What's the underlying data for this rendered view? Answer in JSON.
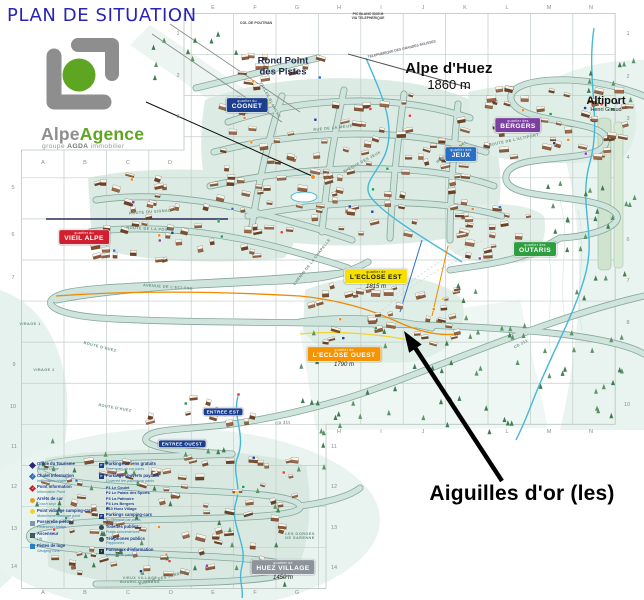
{
  "title": "PLAN DE SITUATION",
  "logo": {
    "brand_gray": "Alpe",
    "brand_green": "Agence",
    "tagline_prefix": "groupe",
    "tagline_bold": "AGDA",
    "tagline_suffix": "immobilier"
  },
  "resort": {
    "name": "Alpe d'Huez",
    "altitude": "1860 m"
  },
  "annotation": {
    "label": "Aiguilles d'or (les)"
  },
  "places": [
    {
      "text": "Rond Point\ndes Pistes",
      "x": 283,
      "y": 67,
      "size": 9.5,
      "weight": "bold",
      "color": "#1d2b50"
    },
    {
      "text": "Altiport",
      "sub": "Henri Giraud",
      "x": 606,
      "y": 104,
      "size": 11,
      "weight": "bold",
      "color": "#111"
    },
    {
      "text": "COL DE POUTRAN",
      "x": 256,
      "y": 23,
      "size": 3.6,
      "weight": "bold",
      "color": "#444"
    },
    {
      "text": "PIC BLANC 3330 M\nVIA TELEPHERIQUE",
      "x": 368,
      "y": 17,
      "size": 3.4,
      "weight": "bold",
      "color": "#444"
    },
    {
      "text": "TELEPHERIQUE DES GRANDES ROUSSES",
      "x": 402,
      "y": 50,
      "size": 3.4,
      "weight": "bold",
      "color": "#667",
      "rot": -13
    }
  ],
  "quartier_badges": [
    {
      "prefix": "quartier du",
      "name": "COGNET",
      "bg": "#1b3f8e",
      "fg": "#ffffff",
      "x": 247,
      "y": 105
    },
    {
      "prefix": "quartier des",
      "name": "JEUX",
      "bg": "#2a6fc4",
      "fg": "#ffffff",
      "x": 461,
      "y": 154
    },
    {
      "prefix": "quartier des",
      "name": "BERGERS",
      "bg": "#7b3fa0",
      "fg": "#ffffff",
      "x": 518,
      "y": 125
    },
    {
      "prefix": "quartier du",
      "name": "VIEIL ALPE",
      "bg": "#d01f2e",
      "fg": "#ffffff",
      "x": 84,
      "y": 237
    },
    {
      "prefix": "quartier des",
      "name": "OUTARIS",
      "bg": "#2f9e41",
      "fg": "#ffffff",
      "x": 535,
      "y": 249
    },
    {
      "prefix": "quartier de",
      "name": "L'ECLOSE EST",
      "bg": "#f6e000",
      "fg": "#111111",
      "x": 376,
      "y": 276,
      "alt": "1815 m"
    },
    {
      "prefix": "quartier de",
      "name": "L'ECLOSE OUEST",
      "bg": "#f59300",
      "fg": "#ffffff",
      "x": 344,
      "y": 354,
      "alt": "1790 m"
    },
    {
      "prefix": "quartier de",
      "name": "HUEZ VILLAGE",
      "bg": "#8d939b",
      "fg": "#ffffff",
      "x": 283,
      "y": 567,
      "alt": "1450 m"
    },
    {
      "prefix": "",
      "name": "ENTREE EST",
      "bg": "#1b3f8e",
      "fg": "#ffffff",
      "x": 223,
      "y": 412,
      "small": true
    },
    {
      "prefix": "",
      "name": "ENTREE OUEST",
      "bg": "#1b3f8e",
      "fg": "#ffffff",
      "x": 182,
      "y": 444,
      "small": true
    }
  ],
  "road_labels": [
    {
      "text": "ROUTE DU SIGNAL",
      "x": 150,
      "y": 212,
      "rot": -4
    },
    {
      "text": "ROUTE DE LA POSTE",
      "x": 150,
      "y": 229,
      "rot": 3
    },
    {
      "text": "ROUTE D'HUEZ",
      "x": 100,
      "y": 347,
      "rot": 14
    },
    {
      "text": "ROUTE D'HUEZ",
      "x": 115,
      "y": 408,
      "rot": 10
    },
    {
      "text": "AVENUE DE L'ECLOSE",
      "x": 168,
      "y": 287,
      "rot": 4
    },
    {
      "text": "CHEMIN DE LA CHAPELLE",
      "x": 312,
      "y": 262,
      "rot": -52
    },
    {
      "text": "ROUTE DE L'ALTIPORT",
      "x": 514,
      "y": 140,
      "rot": -12
    },
    {
      "text": "RUE DE LA MEIJE",
      "x": 333,
      "y": 128,
      "rot": -6
    },
    {
      "text": "AVENUE DES JEUX",
      "x": 362,
      "y": 162,
      "rot": -28
    },
    {
      "text": "RUE DU RIF NEL",
      "x": 452,
      "y": 152,
      "rot": -35
    },
    {
      "text": "VALLEE BLANCHE",
      "x": 270,
      "y": 100,
      "rot": 62
    },
    {
      "text": "CD 211",
      "x": 283,
      "y": 423,
      "rot": -4
    },
    {
      "text": "CD 211",
      "x": 521,
      "y": 344,
      "rot": -28
    },
    {
      "text": "AVENUE DES JARDINS",
      "x": 163,
      "y": 578,
      "rot": -14
    },
    {
      "text": "VIRAGE 1",
      "x": 30,
      "y": 324,
      "rot": 0
    },
    {
      "text": "VIRAGE 2",
      "x": 44,
      "y": 370,
      "rot": 0
    },
    {
      "text": "LES GORGES\nDE SARENNE",
      "x": 300,
      "y": 536,
      "rot": 0
    },
    {
      "text": "VIEUX VILLAGE\nBOURG-D'OISANS",
      "x": 140,
      "y": 580,
      "rot": 0
    }
  ],
  "grid": {
    "letters": [
      {
        "t": "E",
        "x": 213,
        "y": 8
      },
      {
        "t": "F",
        "x": 255,
        "y": 8
      },
      {
        "t": "G",
        "x": 297,
        "y": 8
      },
      {
        "t": "H",
        "x": 339,
        "y": 8
      },
      {
        "t": "I",
        "x": 381,
        "y": 8
      },
      {
        "t": "J",
        "x": 423,
        "y": 8
      },
      {
        "t": "K",
        "x": 465,
        "y": 8
      },
      {
        "t": "L",
        "x": 507,
        "y": 8
      },
      {
        "t": "M",
        "x": 549,
        "y": 8
      },
      {
        "t": "N",
        "x": 591,
        "y": 8
      },
      {
        "t": "A",
        "x": 43,
        "y": 163
      },
      {
        "t": "B",
        "x": 85,
        "y": 163
      },
      {
        "t": "C",
        "x": 128,
        "y": 163
      },
      {
        "t": "D",
        "x": 170,
        "y": 163
      },
      {
        "t": "H",
        "x": 339,
        "y": 432
      },
      {
        "t": "I",
        "x": 381,
        "y": 432
      },
      {
        "t": "J",
        "x": 423,
        "y": 432
      },
      {
        "t": "L",
        "x": 507,
        "y": 432
      },
      {
        "t": "M",
        "x": 549,
        "y": 432
      },
      {
        "t": "N",
        "x": 591,
        "y": 432
      },
      {
        "t": "A",
        "x": 43,
        "y": 593
      },
      {
        "t": "B",
        "x": 85,
        "y": 593
      },
      {
        "t": "C",
        "x": 128,
        "y": 593
      },
      {
        "t": "D",
        "x": 171,
        "y": 593
      },
      {
        "t": "E",
        "x": 213,
        "y": 593
      },
      {
        "t": "F",
        "x": 255,
        "y": 593
      },
      {
        "t": "G",
        "x": 297,
        "y": 593
      }
    ],
    "numbers": [
      {
        "t": "1",
        "x": 178,
        "y": 34
      },
      {
        "t": "2",
        "x": 178,
        "y": 76
      },
      {
        "t": "3",
        "x": 178,
        "y": 117
      },
      {
        "t": "5",
        "x": 13,
        "y": 188
      },
      {
        "t": "6",
        "x": 13,
        "y": 235
      },
      {
        "t": "7",
        "x": 13,
        "y": 278
      },
      {
        "t": "9",
        "x": 14,
        "y": 365
      },
      {
        "t": "10",
        "x": 13,
        "y": 407
      },
      {
        "t": "11",
        "x": 14,
        "y": 447
      },
      {
        "t": "12",
        "x": 14,
        "y": 487
      },
      {
        "t": "13",
        "x": 14,
        "y": 529
      },
      {
        "t": "14",
        "x": 14,
        "y": 567
      },
      {
        "t": "1",
        "x": 628,
        "y": 34
      },
      {
        "t": "2",
        "x": 628,
        "y": 77
      },
      {
        "t": "3",
        "x": 628,
        "y": 119
      },
      {
        "t": "4",
        "x": 628,
        "y": 158
      },
      {
        "t": "6",
        "x": 628,
        "y": 240
      },
      {
        "t": "7",
        "x": 628,
        "y": 281
      },
      {
        "t": "8",
        "x": 628,
        "y": 323
      },
      {
        "t": "10",
        "x": 627,
        "y": 405
      },
      {
        "t": "11",
        "x": 334,
        "y": 447
      },
      {
        "t": "12",
        "x": 334,
        "y": 487
      },
      {
        "t": "13",
        "x": 334,
        "y": 528
      },
      {
        "t": "14",
        "x": 334,
        "y": 568
      }
    ]
  },
  "legend": {
    "left": [
      {
        "fr": "Office du Tourisme",
        "en": "Tourist Office",
        "shape": "diamond",
        "color": "#2b2a72",
        "glyph": ""
      },
      {
        "fr": "Chalet Information",
        "en": "Information chalet",
        "shape": "diamond",
        "color": "#2a6fc4",
        "glyph": "i"
      },
      {
        "fr": "Point Information",
        "en": "Information Point",
        "shape": "diamond",
        "color": "#cf1f2e",
        "glyph": "i"
      },
      {
        "fr": "Arrêts de car",
        "en": "Coach stop",
        "shape": "circle",
        "color": "#e8a020",
        "glyph": ""
      },
      {
        "fr": "Point vidange camping-cars",
        "en": "Motorhome drainage point",
        "shape": "circle",
        "color": "#f2d22e",
        "glyph": ""
      },
      {
        "fr": "Passerelle piétons",
        "en": "Pedestrian bridge",
        "shape": "square",
        "color": "#7d9aaa",
        "glyph": ""
      },
      {
        "fr": "Ascenseur",
        "en": "Lift",
        "shape": "square",
        "color": "#445566",
        "glyph": ""
      },
      {
        "fr": "Pistes de luge",
        "en": "Sledging runs",
        "shape": "square",
        "color": "#2a7fc4",
        "glyph": ""
      }
    ],
    "right": [
      {
        "fr": "Parkings aériens gratuits",
        "en": "Free open-air car parks",
        "shape": "square",
        "color": "#1b3f8e",
        "glyph": "P"
      },
      {
        "fr": "Parkings couverts payants",
        "en": "Covered fee-paying car parks",
        "shape": "square",
        "color": "#1b3f8e",
        "glyph": "P"
      },
      {
        "fr": "Parkings camping-cars",
        "en": "Motorhome car parks",
        "shape": "square",
        "color": "#1b3f8e",
        "glyph": "P"
      },
      {
        "fr": "Toilettes publics",
        "en": "Public conveniences",
        "shape": "circle",
        "color": "#334455",
        "glyph": ""
      },
      {
        "fr": "Téléphones publics",
        "en": "Payphones",
        "shape": "circle",
        "color": "#334455",
        "glyph": ""
      },
      {
        "fr": "Panneaux d'information",
        "en": "Information panels",
        "shape": "square",
        "color": "#223344",
        "glyph": "i"
      }
    ],
    "parkings": [
      "P1  Le Coulet",
      "P2  Le Palais des Sports",
      "P3  La Patinoire",
      "P4  Les Bergers",
      "P10  Huez Village"
    ]
  }
}
